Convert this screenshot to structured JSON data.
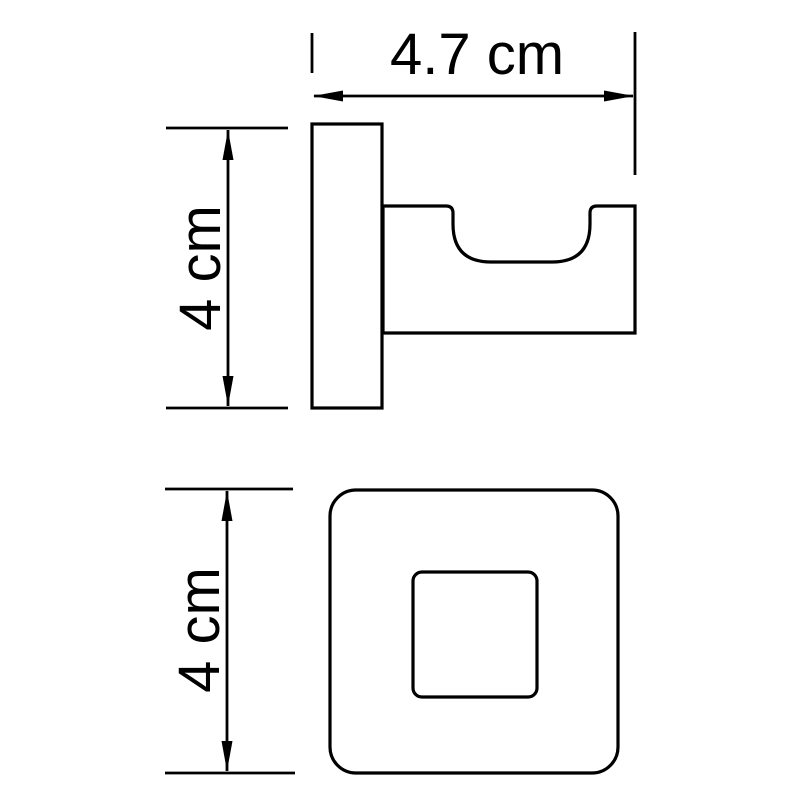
{
  "drawing": {
    "type": "technical-dimension-drawing",
    "subject": "wall-hook-two-view-drawing",
    "colors": {
      "line": "#000000",
      "background": "#ffffff"
    },
    "dimensions": {
      "width": {
        "label": "4.7 cm",
        "value": 4.7,
        "unit": "cm"
      },
      "side_height": {
        "label": "4 cm",
        "value": 4,
        "unit": "cm"
      },
      "front_height": {
        "label": "4 cm",
        "value": 4,
        "unit": "cm"
      }
    }
  }
}
